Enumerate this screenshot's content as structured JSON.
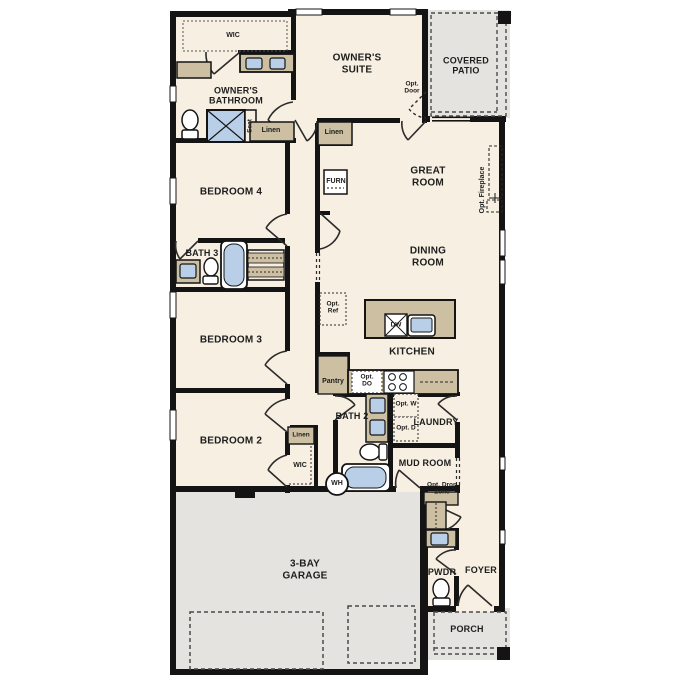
{
  "plan_colors": {
    "floor": "#f7efe2",
    "wall": "#141414",
    "cabinet": "#cdbfa2",
    "fixture_blue": "#b9cfe8",
    "outdoor_gray": "#e4e3e0"
  },
  "rooms": {
    "owners_suite": "OWNER'S SUITE",
    "owners_bathroom": "OWNER'S BATHROOM",
    "wic": "WIC",
    "covered_patio": "COVERED PATIO",
    "great_room": "GREAT ROOM",
    "dining_room": "DINING ROOM",
    "kitchen": "KITCHEN",
    "bedroom_4": "BEDROOM 4",
    "bedroom_3": "BEDROOM 3",
    "bedroom_2": "BEDROOM 2",
    "bath_3": "BATH 3",
    "bath_2": "BATH 2",
    "laundry": "LAUNDRY",
    "mud_room": "MUD ROOM",
    "garage": "3-BAY GARAGE",
    "pwdr": "PWDR",
    "foyer": "FOYER",
    "porch": "PORCH",
    "wic_2": "WIC"
  },
  "annotations": {
    "opt_door": "Opt. Door",
    "opt_fireplace": "Opt. Fireplace",
    "opt_ref": "Opt. Ref",
    "opt_do": "Opt. DO",
    "opt_w": "Opt. W",
    "opt_d": "Opt. D",
    "opt_drop_zone": "Opt. Drop Zone",
    "pantry": "Pantry",
    "furn": "FURN",
    "dw": "DW",
    "wh": "WH",
    "seat": "Seat",
    "linen": "Linen"
  }
}
